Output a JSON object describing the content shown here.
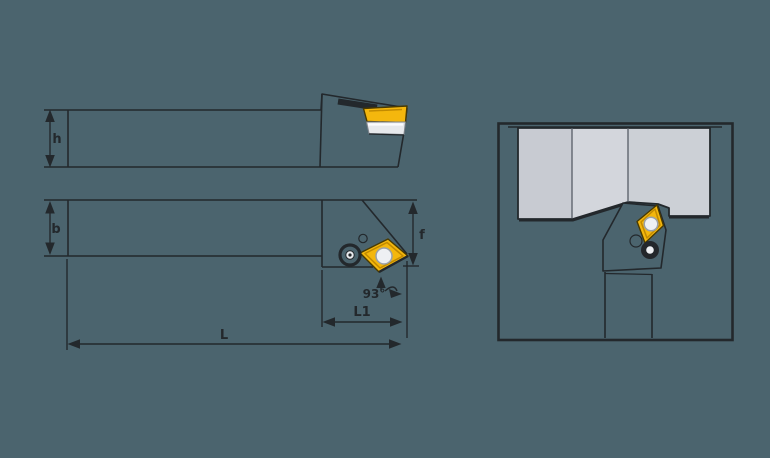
{
  "colors": {
    "background": "#4b646e",
    "line": "#23282c",
    "insert-yellow": "#f4b70d",
    "insert-shade": "#c28a00",
    "workpiece-gray": "#d3d6dc",
    "shim-gray": "#e7e9ec",
    "hole-gray": "#eef0f3"
  },
  "drawing": {
    "subject": "External turning tool holder with diamond indexable insert, three-view technical drawing",
    "views": {
      "side_view": {
        "labels": {
          "shank_height": "h"
        }
      },
      "top_view": {
        "labels": {
          "shank_width": "b",
          "head_width": "f",
          "head_length": "L1",
          "overall_length": "L",
          "lead_angle": "93°"
        }
      },
      "end_view": {
        "labels": {}
      }
    }
  }
}
